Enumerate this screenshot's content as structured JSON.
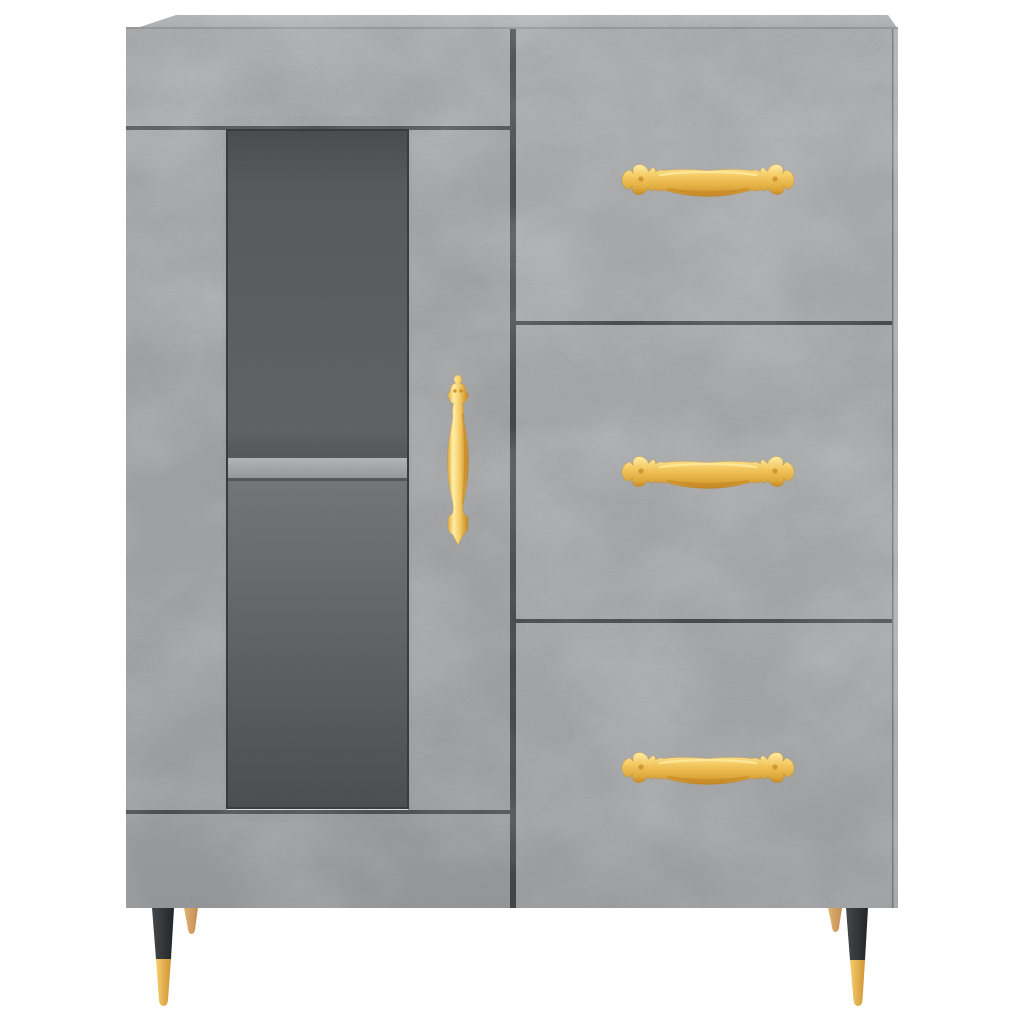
{
  "scene": {
    "type": "product-photo",
    "subject": "sideboard cabinet with glass display door, interior shelf and three drawers",
    "material": "concrete-grey board",
    "hardware": "ornate gold handles, black tapered front legs with brass tips, small wooden rear legs",
    "background": "#ffffff"
  },
  "palette": {
    "background": "#ffffff",
    "concrete_top_light": "#b7b9ba",
    "concrete_top": "#aaacae",
    "concrete_band": "#a6a8aa",
    "concrete_stile": "#a2a4a6",
    "concrete_door_bottom": "#a1a3a5",
    "concrete_drawer": "#a8aaac",
    "concrete_side": "#b5b6b7",
    "seam": "#3e4042",
    "glass_border": "#35373a",
    "glass_top": "#47494b",
    "glass_upper": "#555759",
    "glass_mid": "#5e6062",
    "glass_preshelf": "#535557",
    "glass_below": "#727476",
    "glass_low": "#686a6c",
    "glass_bottom": "#494b4d",
    "shelf_light": "#b6b7b8",
    "shelf_dark": "#97999a",
    "shelf_shadow": "#3f4142",
    "gold_light": "#feeca4",
    "gold": "#f5cb64",
    "gold_dark": "#dfa93c",
    "gold_deep": "#c08222",
    "gold_edge": "#b9821f",
    "brass_light": "#f6cd6e",
    "brass_dark": "#d09434",
    "leg_black_light": "#45484a",
    "leg_black": "#232527",
    "wood_light": "#e2b375",
    "wood_dark": "#c08e50"
  }
}
